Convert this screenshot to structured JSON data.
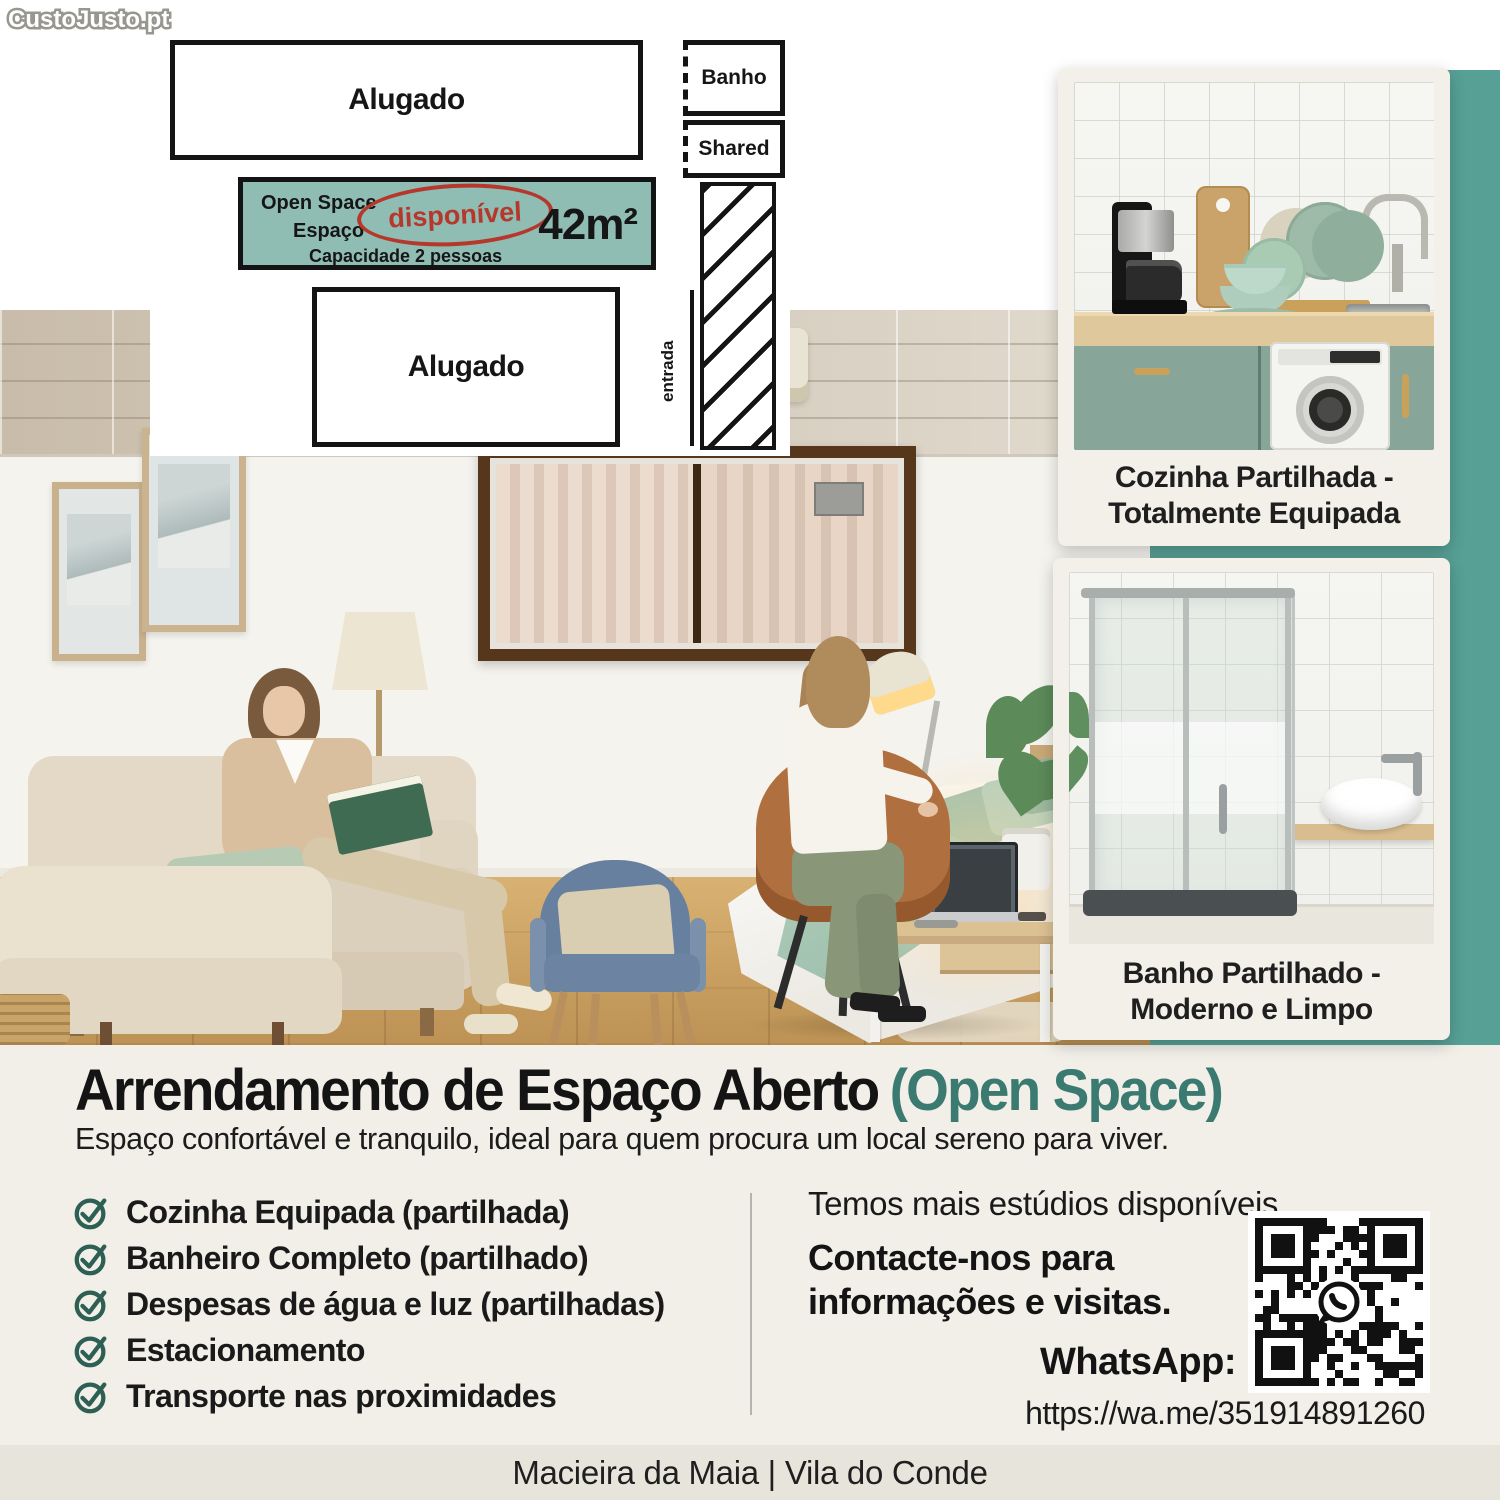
{
  "brand": {
    "logo": "CustoJusto.pt"
  },
  "floor_plan": {
    "rooms": {
      "top_unit": "Alugado",
      "bottom_unit": "Alugado",
      "bath": "Banho",
      "shared": "Shared",
      "entrance": "entrada"
    },
    "open_space": {
      "line1": "Open Space",
      "line2": "Espaço",
      "line3": "Capacidade 2 pessoas",
      "status": "disponível",
      "area": "42m²"
    }
  },
  "gallery": {
    "kitchen": {
      "caption_line1": "Cozinha Partilhada -",
      "caption_line2": "Totalmente Equipada"
    },
    "bathroom": {
      "caption_line1": "Banho Partilhado -",
      "caption_line2": "Moderno e Limpo"
    }
  },
  "details": {
    "title": "Arrendamento de Espaço Aberto",
    "title_highlight": "(Open Space)",
    "subtitle": "Espaço confortável e tranquilo, ideal para quem procura um local sereno para viver.",
    "features": [
      "Cozinha Equipada (partilhada)",
      "Banheiro Completo (partilhado)",
      "Despesas de água e luz (partilhadas)",
      "Estacionamento",
      "Transporte nas proximidades"
    ],
    "more_text": "Temos mais estúdios disponíveis.",
    "contact_line1": "Contacte-nos para",
    "contact_line2": "informações e visitas.",
    "whatsapp_label": "WhatsApp:",
    "whatsapp_url": "https://wa.me/351914891260"
  },
  "footer": {
    "location": "Macieira da Maia | Vila do Conde"
  },
  "colors": {
    "teal_panel": "#57a096",
    "plan_room_teal": "#8fbdb3",
    "accent_teal": "#3a7a70",
    "check_green": "#2d5f54",
    "status_red": "#b6372c"
  }
}
